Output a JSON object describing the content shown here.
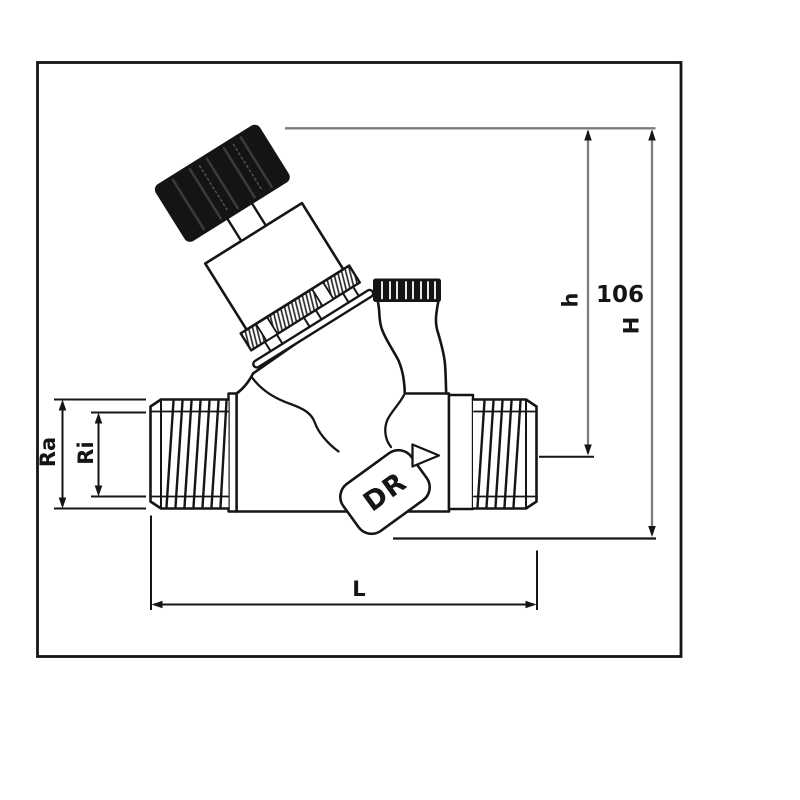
{
  "drawing": {
    "kind": "pressure-reducing-valve-dimension-drawing"
  },
  "dimensions": {
    "outer_thread_radius": {
      "label": "Ra"
    },
    "inner_thread_radius": {
      "label": "Ri"
    },
    "length": {
      "label": "L"
    },
    "cap_height": {
      "label": "h"
    },
    "total_height": {
      "label": "H",
      "value": "106"
    }
  },
  "valve": {
    "body_marking": "DR",
    "flow_direction_icon": "right-pointing-triangle"
  },
  "colors": {
    "line": "#151515",
    "dimension_gray": "#7c7c7c",
    "cap_black": "#141414",
    "background": "#ffffff"
  }
}
